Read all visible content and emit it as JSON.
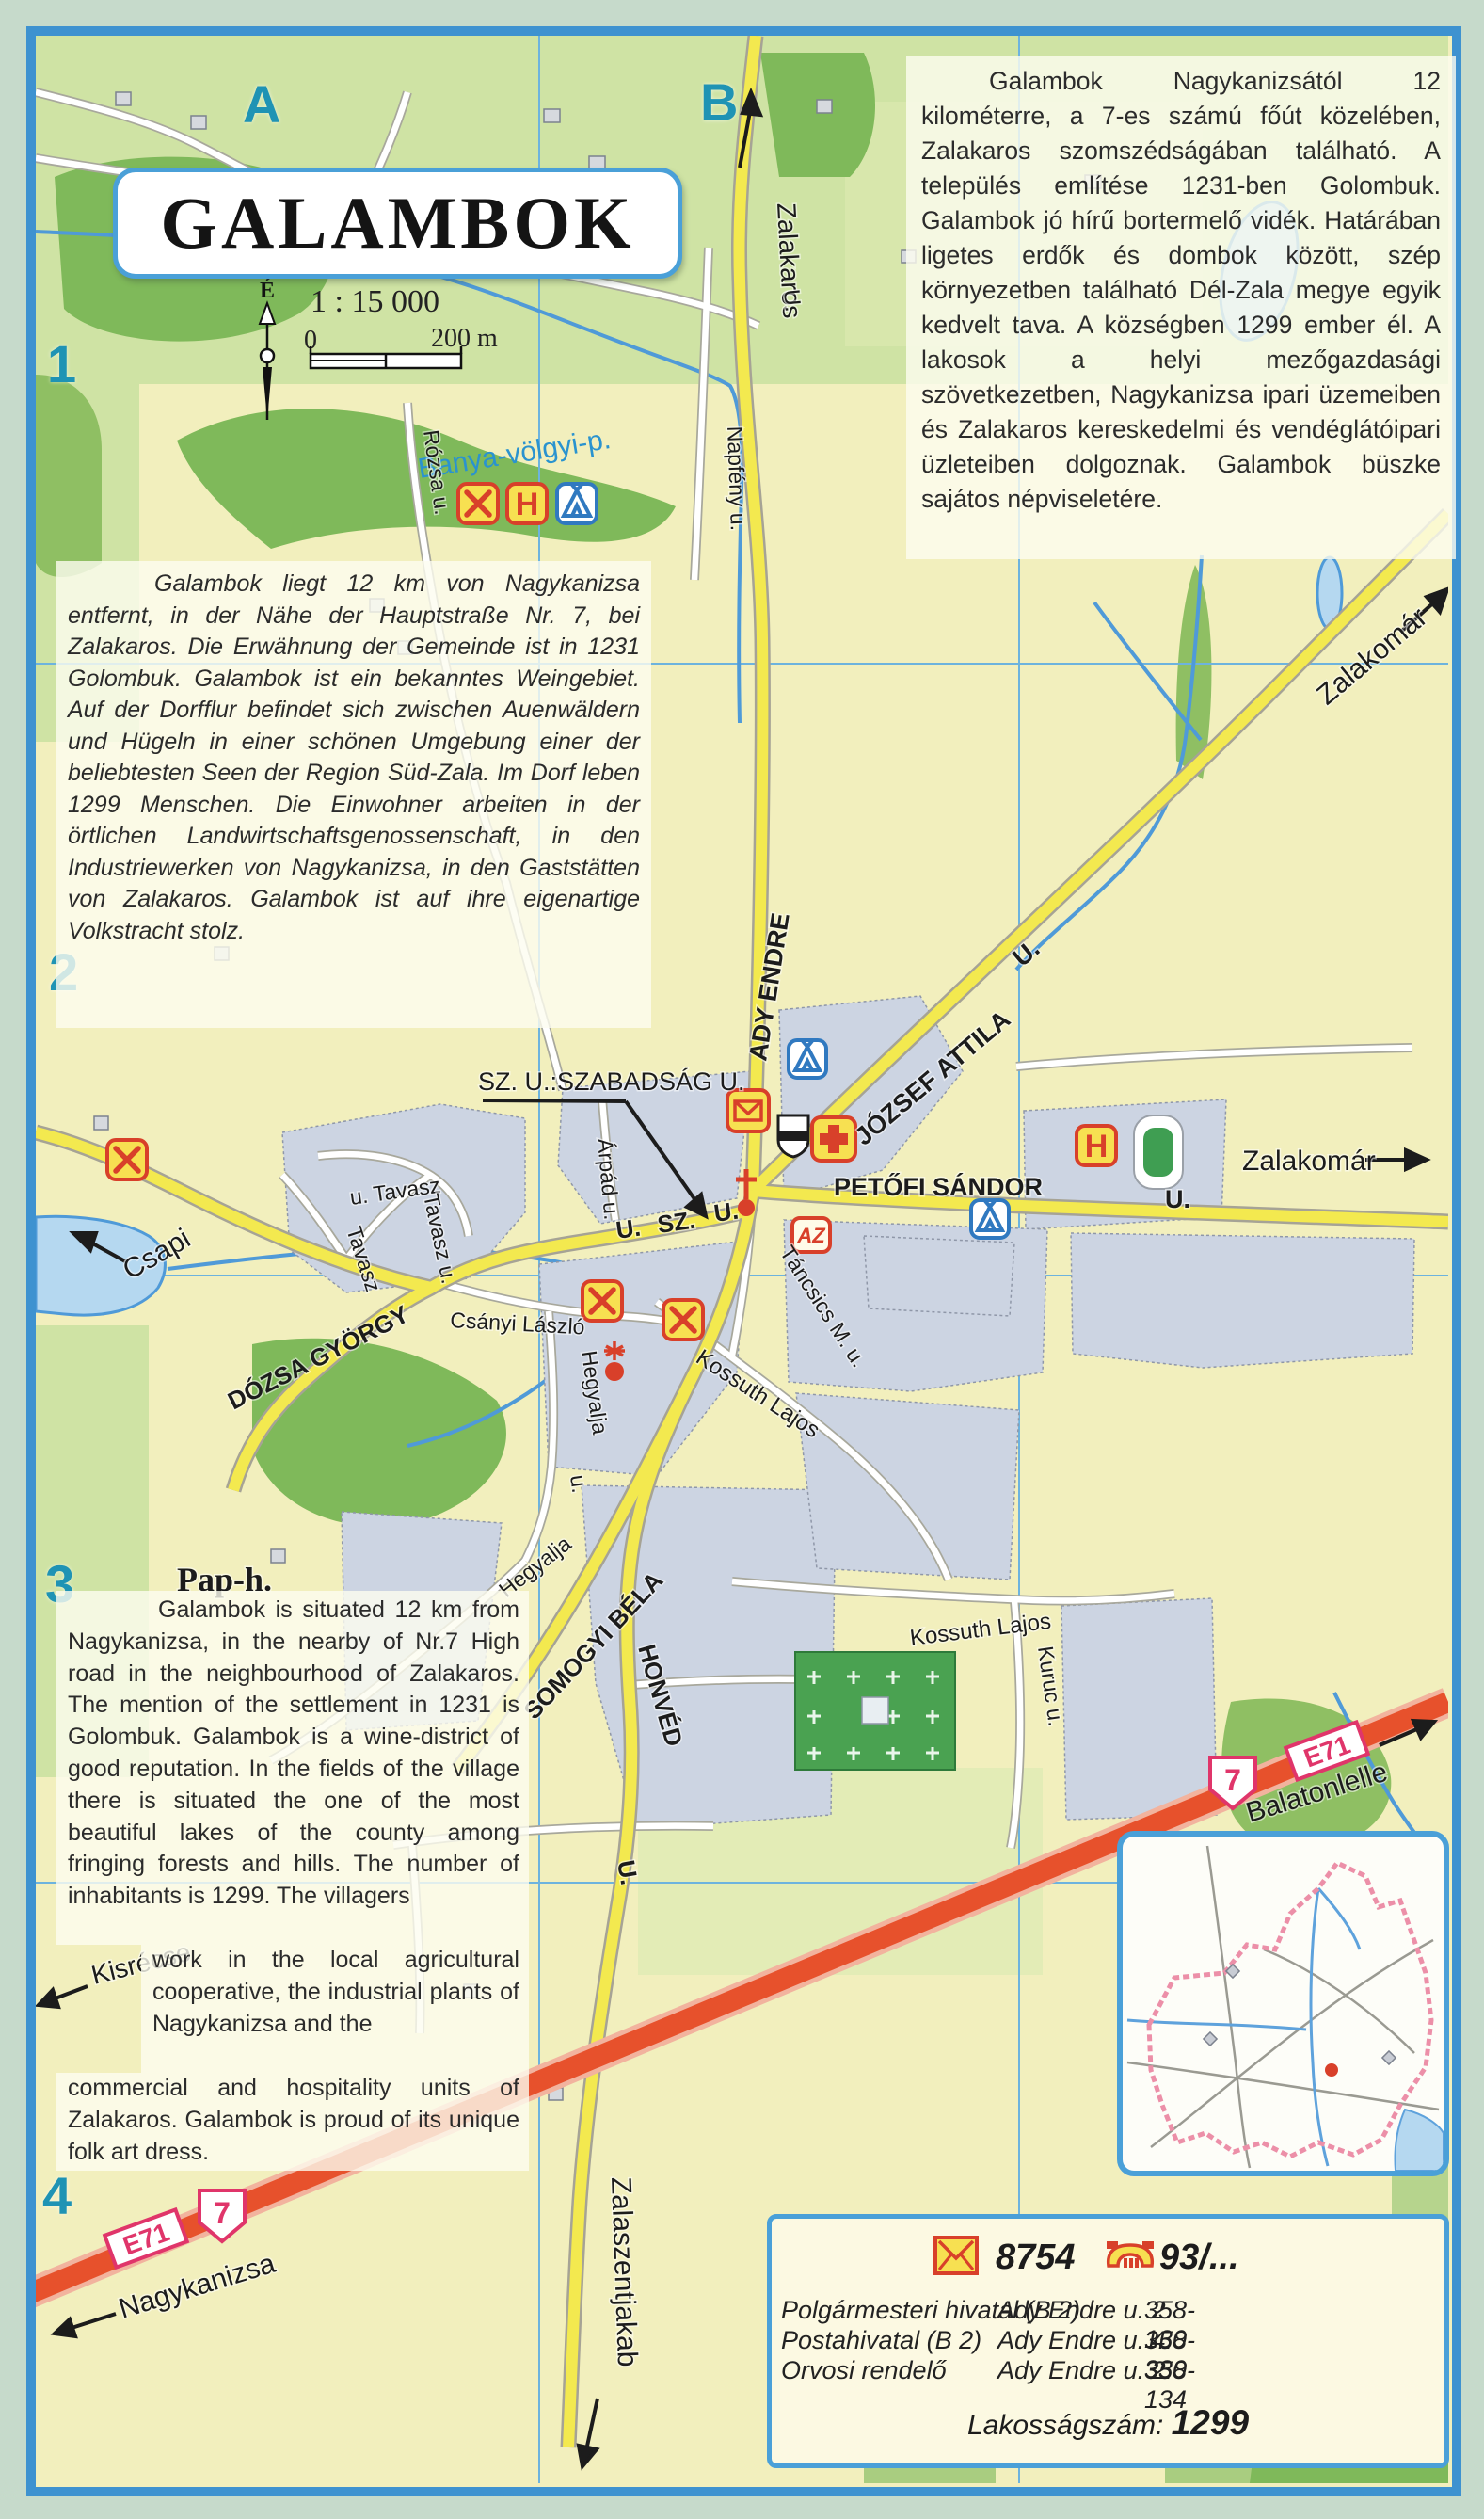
{
  "page": {
    "title": "GALAMBOK",
    "scale_text": "1 : 15 000",
    "scale_zero": "0",
    "scale_distance": "200 m",
    "compass_north": "É"
  },
  "grid": {
    "col_a": "A",
    "col_b": "B",
    "row_1": "1",
    "row_2": "2",
    "row_3": "3",
    "row_4": "4"
  },
  "texts": {
    "hungarian": "Galambok Nagykanizsától 12 kilométerre, a 7-es számú főút közelében, Zalakaros szomszédságában található. A település említése 1231-ben Golombuk. Galambok jó hírű bortermelő vidék. Határában ligetes erdők és dombok között, szép környezetben található Dél-Zala megye egyik kedvelt tava. A községben 1299 ember él. A lakosok a helyi mezőgazdasági szövetkezetben, Nagykanizsa ipari üzemeiben és Zalakaros kereskedelmi és vendéglátóipari üzleteiben dolgoznak. Galambok büszke sajátos népviseletére.",
    "german": "Galambok liegt 12 km von Nagykanizsa entfernt, in der Nähe der Hauptstraße Nr. 7, bei Zalakaros. Die Erwähnung der Gemeinde ist in 1231 Golombuk. Galambok ist ein bekanntes Weingebiet. Auf der Dorfflur befindet sich zwischen Auenwäldern und Hügeln in einer schönen Umgebung einer der beliebtesten Seen der Region Süd-Zala. Im Dorf leben 1299 Menschen. Die Einwohner arbeiten in der örtlichen Landwirtschaftsgenossenschaft, in den Industriewerken von Nagykanizsa, in den Gaststätten von Zalakaros. Galambok ist auf ihre eigenartige Volkstracht stolz.",
    "english_1": "Galambok is situated 12 km from Nagykanizsa, in the nearby of Nr.7 High road in the neighbourhood of Zalakaros. The mention of the settlement in 1231 is Golombuk. Galambok is a wine-district of good reputation. In the fields of the village there is situated the one of the most beautiful lakes of the county among fringing forests and hills. The number of inhabitants is 1299. The villagers",
    "english_2": "work in the local agricultural cooperative, the industrial plants of Nagykanizsa and the",
    "english_3": "commercial and hospitality units of Zalakaros. Galambok is proud of its unique folk art dress."
  },
  "map": {
    "labels": {
      "zalakaros": "Zalakaros",
      "banya_volgyi": "Banya-völgyi-p.",
      "napfeny": "Napfény u.",
      "u_top": "U.",
      "rozsa": "Rózsa u.",
      "ady_endre": "ADY ENDRE",
      "jozsef_attila": "JÓZSEF ATTILA",
      "jozsef_attila_u": "U.",
      "zalakomar_ne": "Zalakomár",
      "zalakomar_e": "Zalakomár",
      "szabadsag_note": "SZ. U.:SZABADSÁG U.",
      "sz_u_a": "U.",
      "sz_u_b": "SZ.",
      "sz_u_c": "U.",
      "petofi": "PETŐFI SÁNDOR",
      "petofi_u": "U.",
      "arpad": "Árpád u.",
      "tancsics": "Táncsics M.  u.",
      "csanyi": "Csányi László",
      "hegyalja_1": "Hegyalja",
      "hegyalja_1u": "u.",
      "hegyalja_2": "Hegyalja",
      "kossuth_1": "Kossuth  Lajos",
      "kossuth_2": "Kossuth  Lajos",
      "kuruc": "Kuruc  u.",
      "dozsa": "DÓZSA GYÖRGY",
      "tavasz_1": "u. Tavasz",
      "tavasz_2": "Tavasz",
      "tavasz_3": "Tavasz u.",
      "csapi": "Csapi",
      "somogyi": "SOMOGYI BÉLA",
      "honved": "HONVÉD",
      "honved_u": "U.",
      "zalaszentjakab": "Zalaszentjakab",
      "kisrecse": "Kisrécse",
      "nagykanizsa": "Nagykanizsa",
      "balatonlelle": "Balatonlelle",
      "pap_h": "Pap-h.",
      "route_7": "7",
      "route_e71": "E71",
      "hotel_letter": "H",
      "az_badge": "AZ"
    }
  },
  "info_box": {
    "postal_code": "8754",
    "phone_prefix": "93/...",
    "rows": [
      {
        "name": "Polgármesteri hivatal (B 2)",
        "address": "Ady Endre u. 2.",
        "phone": "358-130"
      },
      {
        "name": "Postahivatal (B 2)",
        "address": "Ady Endre u. 4.",
        "phone": "358-330"
      },
      {
        "name": "Orvosi rendelő",
        "address": "Ady Endre u. 2.",
        "phone": "358-134"
      }
    ],
    "population_label": "Lakosságszám:",
    "population_value": "1299"
  },
  "colors": {
    "frame_blue": "#3e92d0",
    "road_yellow": "#f3e94f",
    "highway_red": "#e7512c",
    "water_blue": "#4f9ad8",
    "forest_green": "#7fb95a",
    "grid_teal": "#1f93b4",
    "badge_red": "#d8402a",
    "badge_yellow": "#f7e051"
  }
}
